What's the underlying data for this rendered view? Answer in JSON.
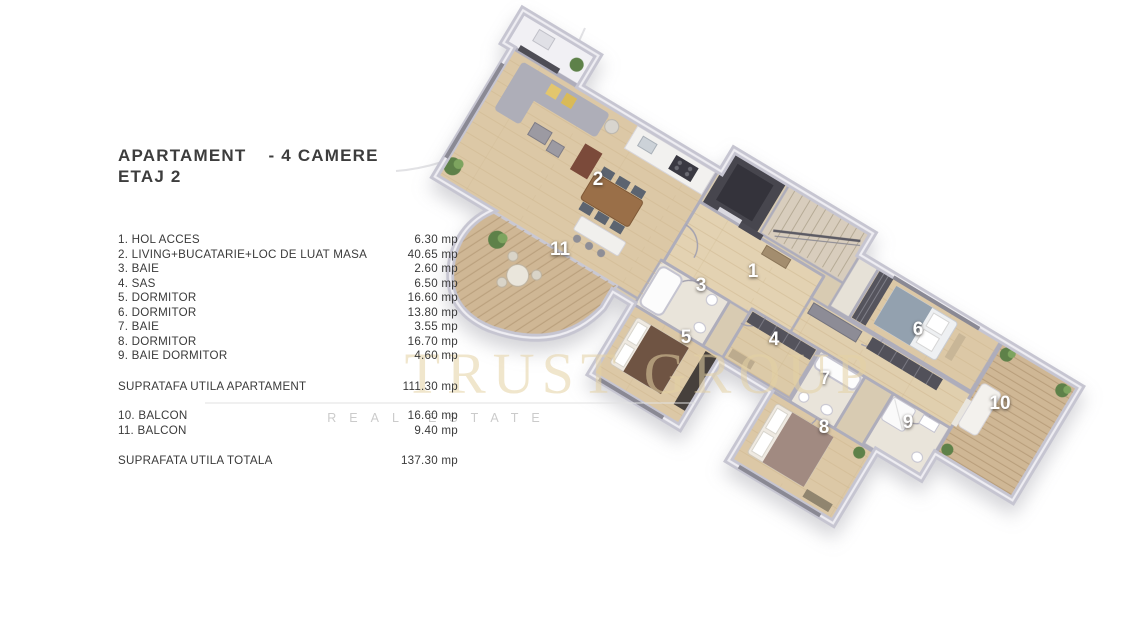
{
  "header": {
    "title_left": "APARTAMENT",
    "title_right": "- 4 CAMERE",
    "subtitle": "ETAJ 2"
  },
  "room_list": [
    {
      "label": "1. HOL ACCES",
      "area": "6.30 mp"
    },
    {
      "label": "2. LIVING+BUCATARIE+LOC DE LUAT MASA",
      "area": "40.65 mp"
    },
    {
      "label": "3. BAIE",
      "area": "2.60 mp"
    },
    {
      "label": "4. SAS",
      "area": "6.50 mp"
    },
    {
      "label": "5. DORMITOR",
      "area": "16.60 mp"
    },
    {
      "label": "6. DORMITOR",
      "area": "13.80 mp"
    },
    {
      "label": "7. BAIE",
      "area": "3.55 mp"
    },
    {
      "label": "8. DORMITOR",
      "area": "16.70 mp"
    },
    {
      "label": "9. BAIE DORMITOR",
      "area": "4.60 mp"
    }
  ],
  "summary": {
    "subtotal_label": "SUPRATAFA UTILA APARTAMENT",
    "subtotal_area": "111.30 mp",
    "balconies": [
      {
        "label": "10. BALCON",
        "area": "16.60 mp"
      },
      {
        "label": "11. BALCON",
        "area": "9.40 mp"
      }
    ],
    "total_label": "SUPRAFATA UTILA TOTALA",
    "total_area": "137.30 mp"
  },
  "watermark": {
    "line1": "TRUST GROUP",
    "line2": "REAL ESTATE",
    "gold": "#e5d2a4"
  },
  "floorplan": {
    "room_labels": [
      {
        "n": "1",
        "x": 753,
        "y": 277
      },
      {
        "n": "2",
        "x": 598,
        "y": 185
      },
      {
        "n": "3",
        "x": 701,
        "y": 291
      },
      {
        "n": "4",
        "x": 774,
        "y": 345
      },
      {
        "n": "5",
        "x": 686,
        "y": 343
      },
      {
        "n": "6",
        "x": 918,
        "y": 335
      },
      {
        "n": "7",
        "x": 825,
        "y": 384
      },
      {
        "n": "8",
        "x": 824,
        "y": 433
      },
      {
        "n": "9",
        "x": 908,
        "y": 428
      },
      {
        "n": "10",
        "x": 1000,
        "y": 409
      },
      {
        "n": "11",
        "x": 560,
        "y": 255
      }
    ],
    "colors": {
      "wood_floor": "#dcc8a6",
      "deck": "#cfb795",
      "wall": "#c6c5d1",
      "dark_core": "#47464e",
      "text": "#3c3c3c"
    }
  }
}
